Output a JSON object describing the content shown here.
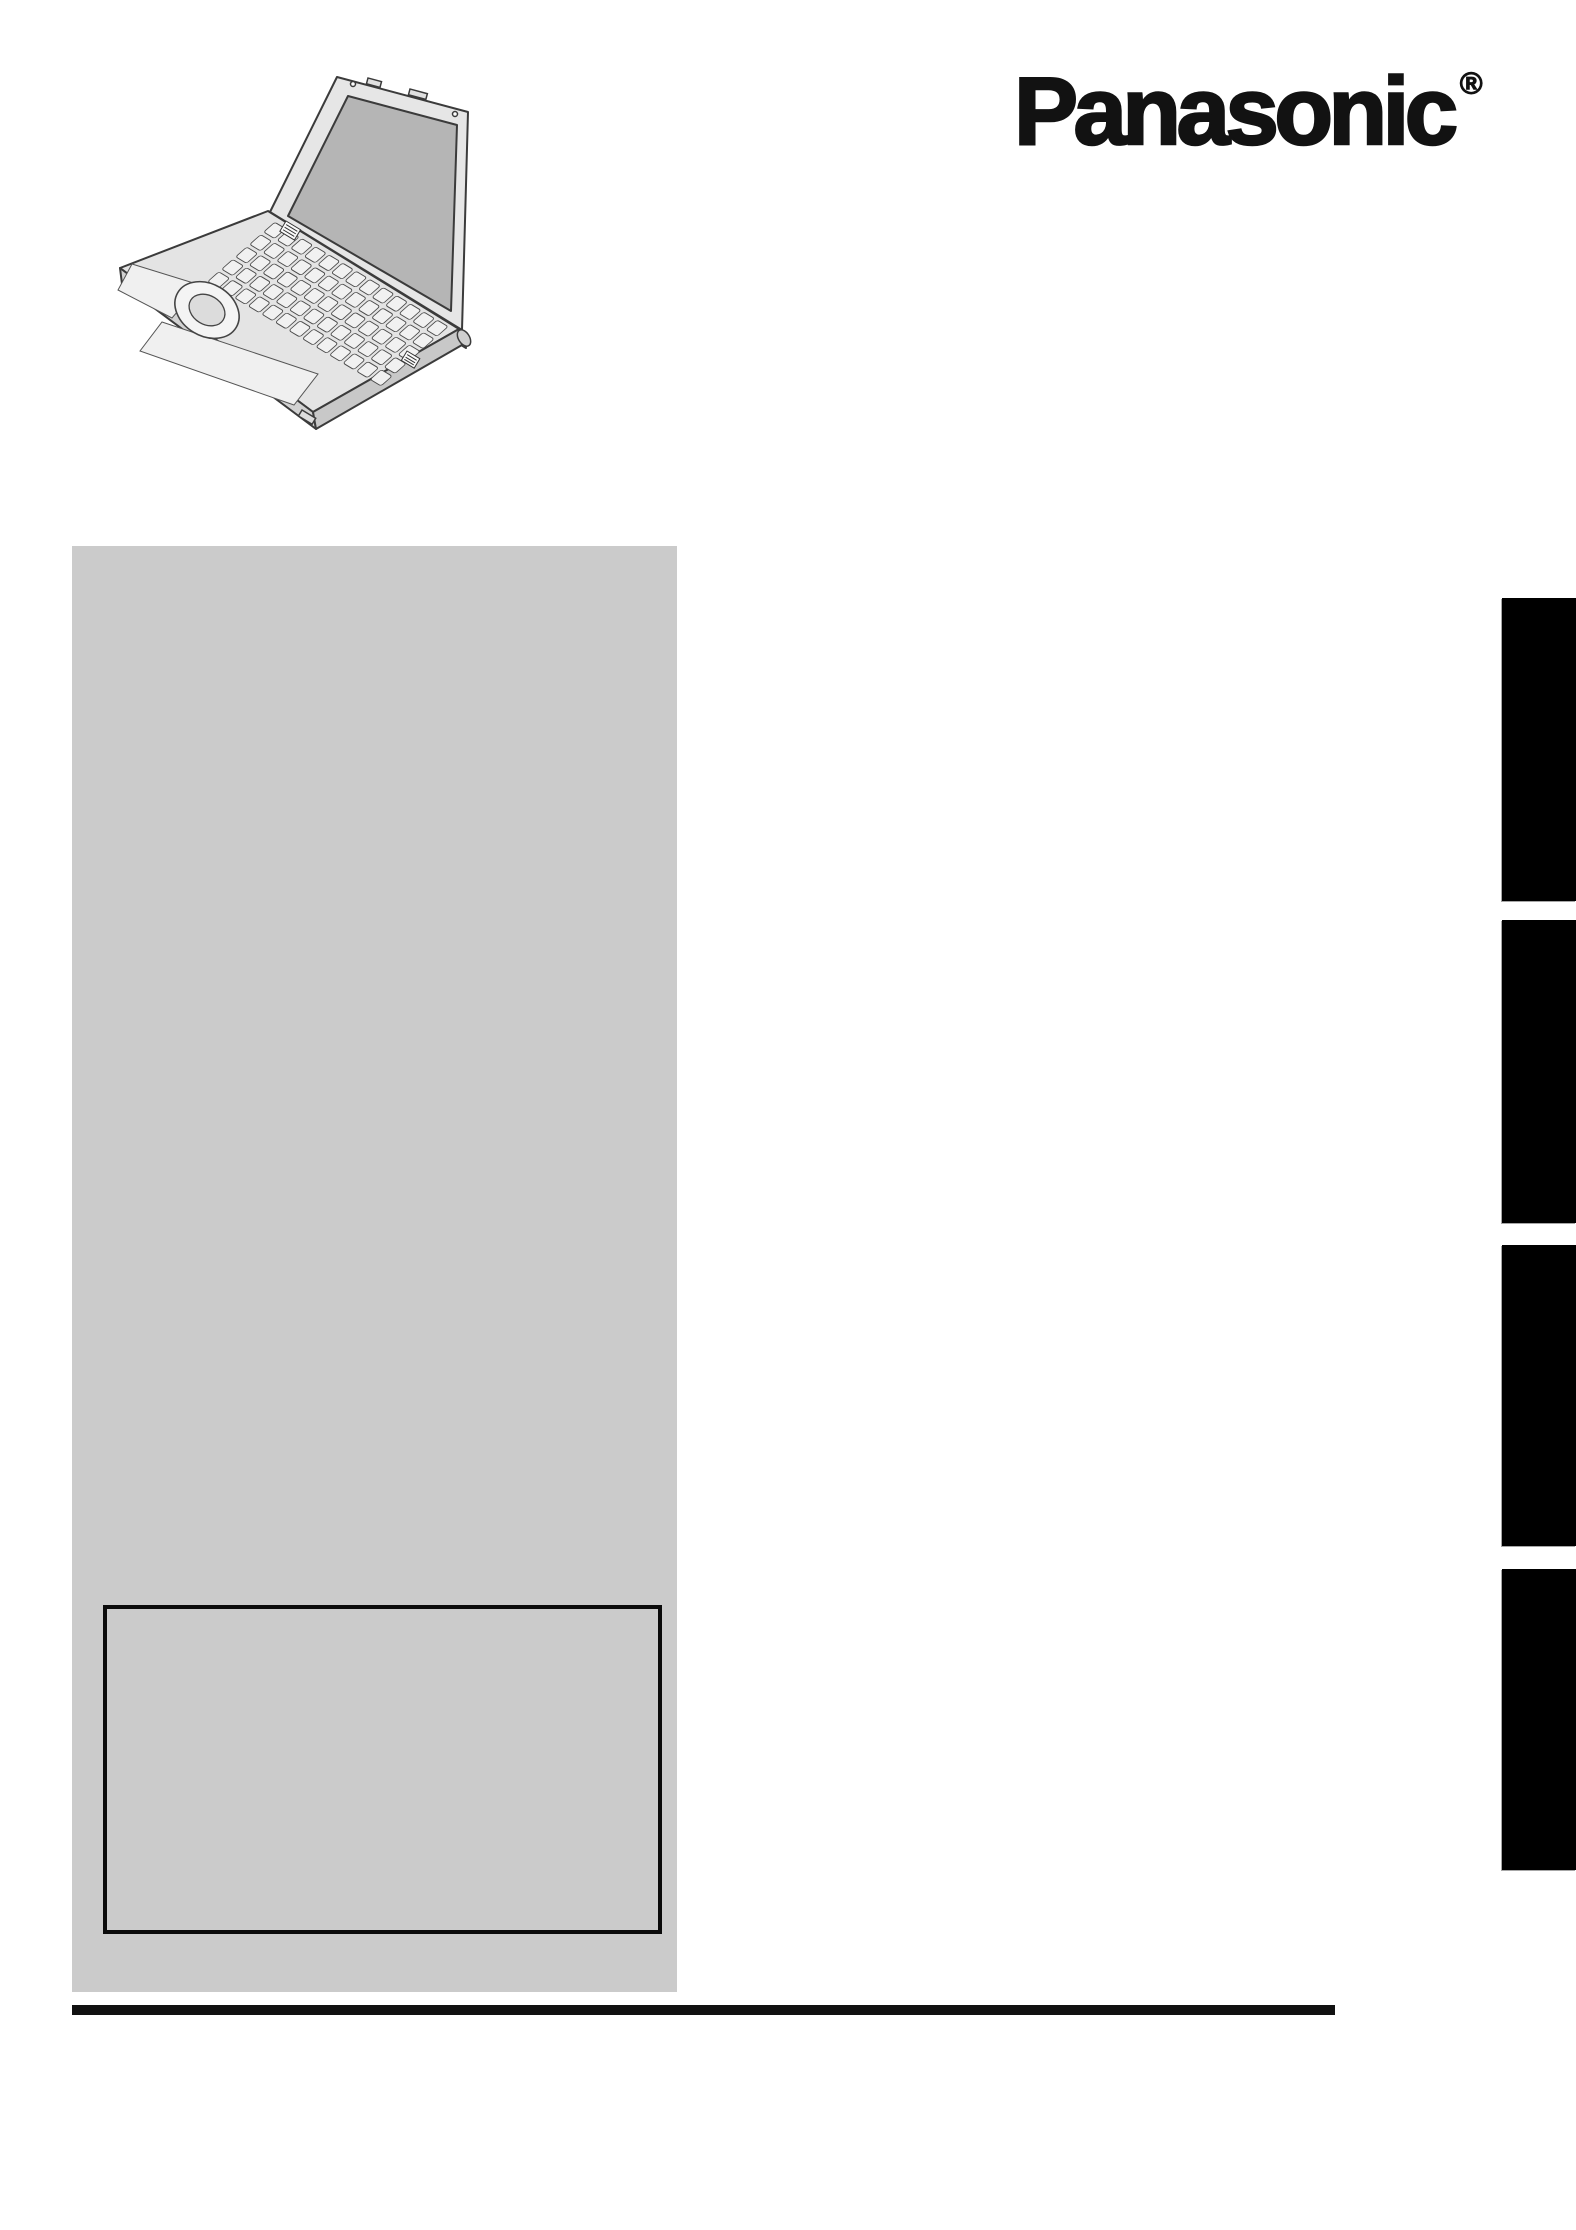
{
  "brand": {
    "logo_text": "Panasonic",
    "registered_mark": "®"
  },
  "illustration": {
    "label": "laptop-line-drawing"
  },
  "sections": {
    "tab_count": 4,
    "tabs": [
      {
        "id": "tab-1",
        "label": ""
      },
      {
        "id": "tab-2",
        "label": ""
      },
      {
        "id": "tab-3",
        "label": ""
      },
      {
        "id": "tab-4",
        "label": ""
      }
    ]
  },
  "info_box": {
    "text": ""
  },
  "colors": {
    "page_bg": "#ffffff",
    "panel_gray": "#cbcbcb",
    "tab_black": "#000000",
    "rule_black": "#111111",
    "box_border": "#0b0b0b",
    "logo_black": "#121212",
    "screen_gray": "#b5b5b5"
  }
}
